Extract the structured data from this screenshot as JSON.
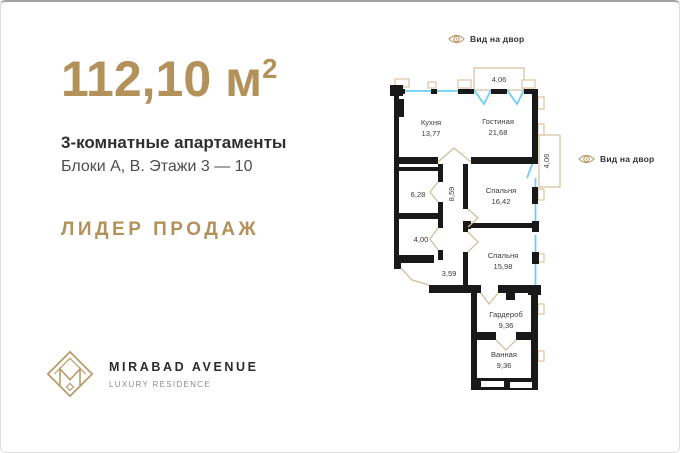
{
  "hero": {
    "area": "112,10 м",
    "area_sup": "2",
    "type": "3-комнатные апартаменты",
    "blocks": "Блоки А, В. Этажи 3 — 10",
    "badge": "ЛИДЕР ПРОДАЖ"
  },
  "logo": {
    "name": "MIRABAD AVENUE",
    "tagline": "LUXURY RESIDENCE"
  },
  "floorplan": {
    "view_labels": [
      "Вид на двор",
      "Вид на двор"
    ],
    "balconies": [
      "4,06",
      "4,06"
    ],
    "rooms": [
      {
        "name": "Кухня",
        "area": "13,77"
      },
      {
        "name": "Гостиная",
        "area": "21,68"
      },
      {
        "name": "",
        "area": "6,28"
      },
      {
        "name": "",
        "area": "8,59"
      },
      {
        "name": "Спальня",
        "area": "16,42"
      },
      {
        "name": "",
        "area": "4,00"
      },
      {
        "name": "Спальня",
        "area": "15,98"
      },
      {
        "name": "",
        "area": "3,59"
      },
      {
        "name": "Гардероб",
        "area": "9,36"
      },
      {
        "name": "Ванная",
        "area": "9,36"
      }
    ],
    "colors": {
      "wall": "#191919",
      "window": "#6fcdf2",
      "plan_accent": "#d4bf9d",
      "gold": "#b3915a"
    }
  }
}
